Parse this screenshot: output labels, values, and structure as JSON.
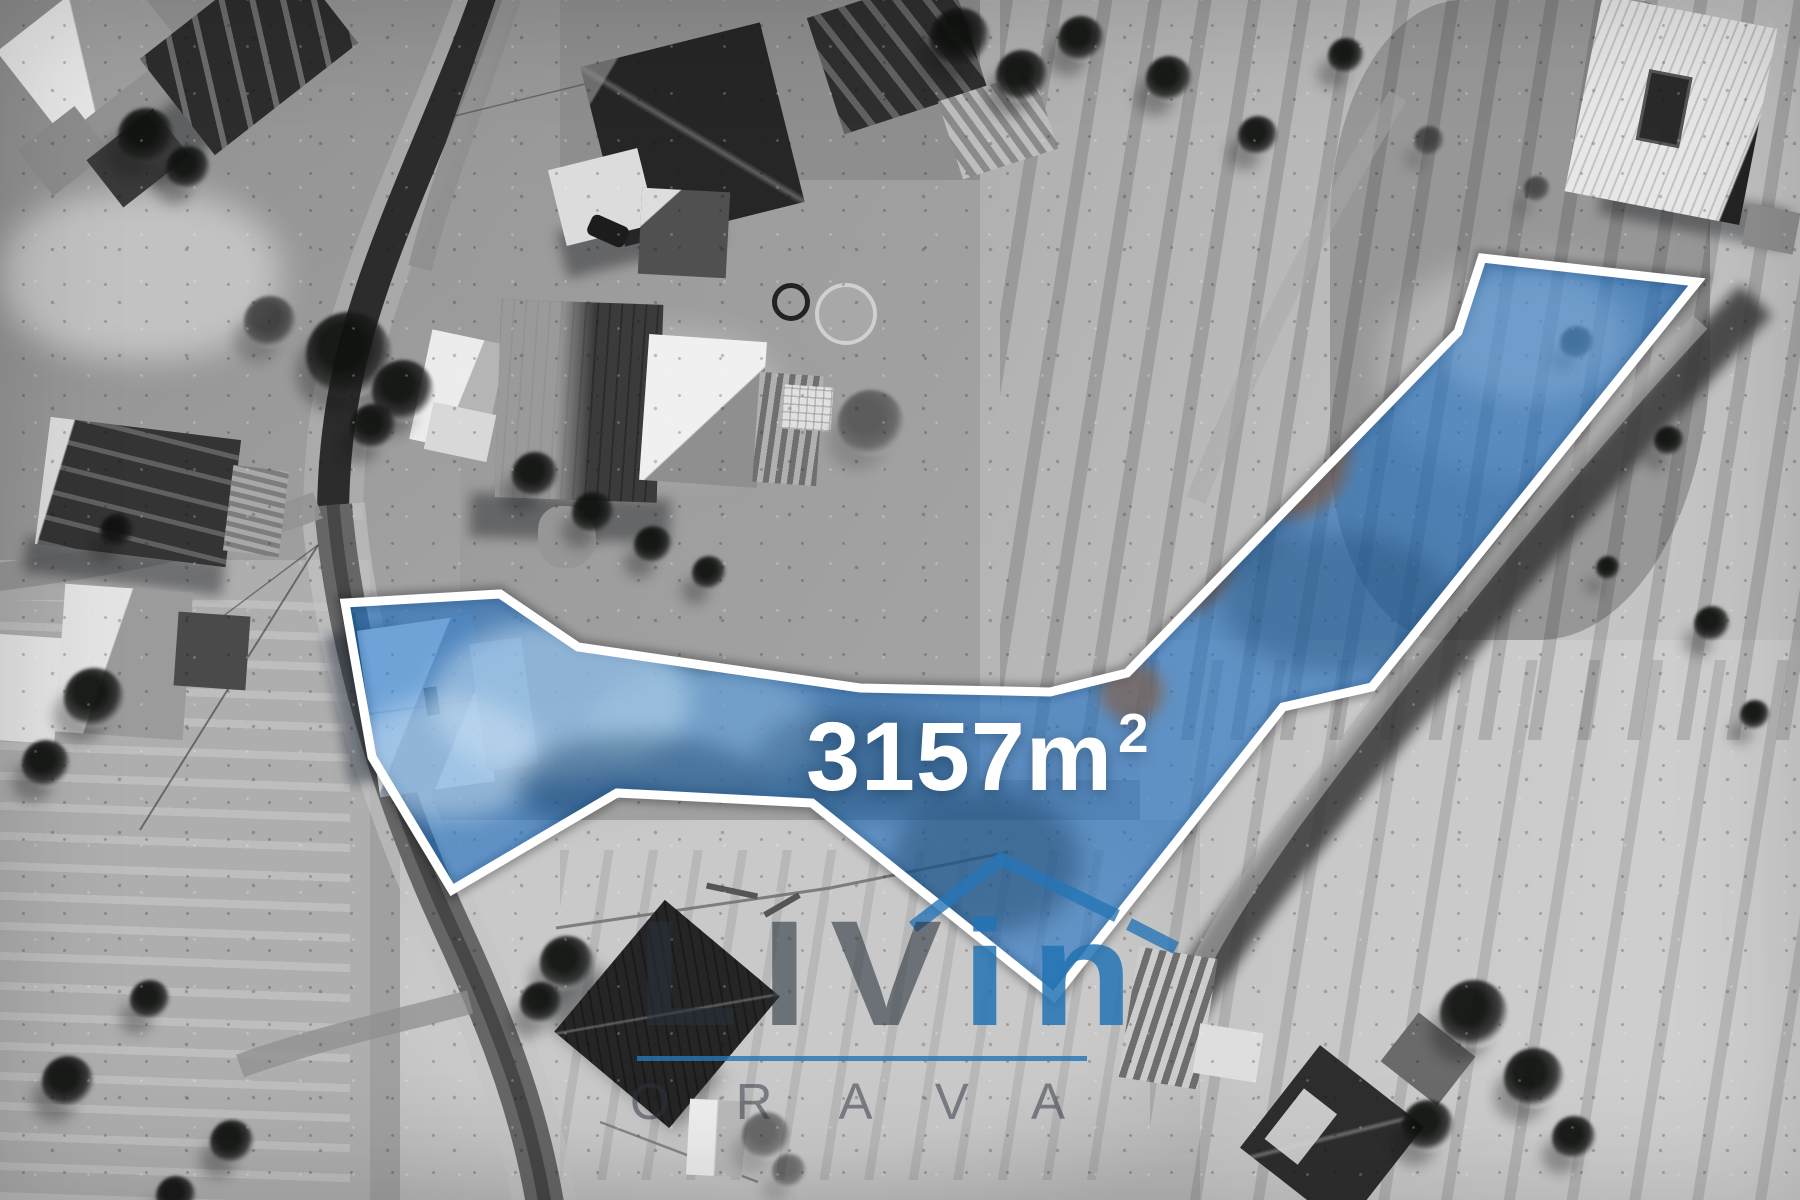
{
  "scene": {
    "description": "black-and-white winter aerial drone photo of a village with a highlighted building plot",
    "accent_blue": "#2a7ab8"
  },
  "parcel": {
    "area_value": "3157",
    "area_unit": "m",
    "area_exponent": "2",
    "area_display": "3157m²",
    "outline_points": "345,603 500,594 578,647 860,688 1050,692 1127,673 1458,332 1482,258 1697,282 1372,687 1283,707 1054,997 812,803 617,793 452,890 372,757",
    "fill_color": "#1e6fc4",
    "border_color": "#ffffff"
  },
  "watermark": {
    "brand_part1": "LIV",
    "brand_part2": "in",
    "sub_brand": "ORAVA",
    "accent_color": "#2a7ab8",
    "dark_color": "#2a3038"
  }
}
